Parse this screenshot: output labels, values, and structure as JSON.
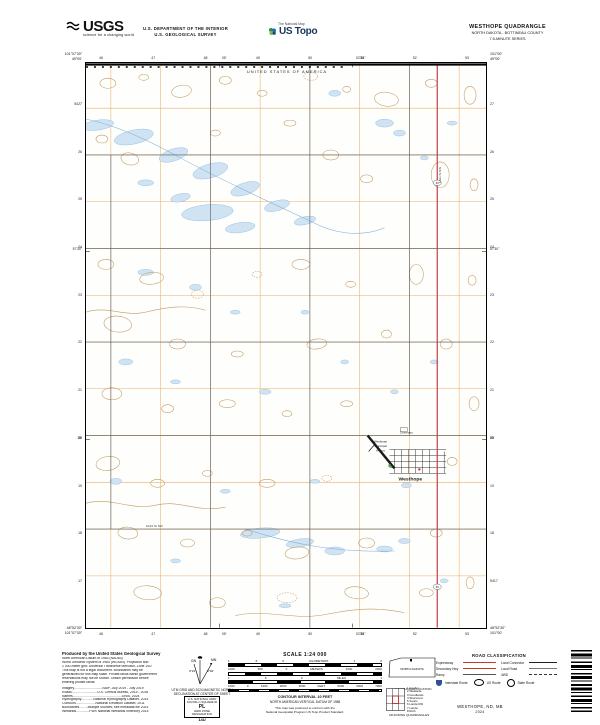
{
  "header": {
    "usgs_logo": "USGS",
    "usgs_tagline": "science for a changing world",
    "dept1": "U.S. DEPARTMENT OF THE INTERIOR",
    "dept2": "U.S. GEOLOGICAL SURVEY",
    "ustopo_small": "The National Map",
    "ustopo_brand": "US Topo",
    "quad_title": "WESTHOPE QUADRANGLE",
    "quad_county": "NORTH DAKOTA - BOTTINEAU COUNTY",
    "quad_series": "7.5-MINUTE SERIES"
  },
  "map": {
    "boundary_label": "UNITED STATES OF AMERICA",
    "grid_top": [
      "46",
      "47",
      "48",
      "49",
      "50",
      "51",
      "52",
      "53"
    ],
    "grid_bottom": [
      "46",
      "47",
      "48",
      "49",
      "50",
      "51",
      "52",
      "53"
    ],
    "grid_left": [
      "5427",
      "26",
      "25",
      "24",
      "23",
      "22",
      "21",
      "20",
      "19",
      "18",
      "17"
    ],
    "grid_right": [
      "27",
      "26",
      "25",
      "24",
      "23",
      "22",
      "21",
      "20",
      "19",
      "18",
      "5417"
    ],
    "corners": {
      "tl_lon": "101°07'30\"",
      "tl_lat": "49°00'",
      "tr_lon": "101°00'",
      "tr_lat": "49°00'",
      "bl_lat": "48°52'30\"",
      "bl_lon": "101°07'30\"",
      "br_lat": "48°52'30\"",
      "br_lon": "101°00'"
    },
    "minutes": {
      "top_1": "05'",
      "top_2": "02'30\"",
      "bottom_1": "05'",
      "bottom_2": "02'30\"",
      "left_1": "57'30\"",
      "left_2": "55'",
      "right_1": "57'30\"",
      "right_2": "55'"
    },
    "labels": {
      "town": "Westhope",
      "airport_1": "Westhope",
      "airport_2": "Municipal",
      "airport_3": "Airport",
      "cemetery": "Cemetery",
      "main_street": "Main St NW",
      "section_street": "103rd St NW",
      "route_number": "83"
    }
  },
  "footer": {
    "produced_by": "Produced by the United States Geological Survey",
    "notes": [
      "North American Datum of 1983 (NAD83)",
      "World Geodetic System of 1984 (WGS84). Projection and",
      "1 000-meter grid: Universal Transverse Mercator, Zone 14U",
      "This map is not a legal document. Boundaries may be",
      "generalized for this map scale. Private lands within government",
      "reservations may not be shown. Obtain permission before",
      "entering private lands."
    ],
    "sources": [
      "Imagery..............................NAIP, July 2019 - July 2019",
      "Roads...........................U.S. Census Bureau, 2015 - 2016",
      "Names....................................................GNIS, 2024",
      "Hydrography.............National Hydrography Dataset, 2014",
      "Contours.....................National Elevation Dataset, 2011",
      "Boundaries.........Multiple sources; see metadata file 2023",
      "Wetlands..............FWS National Wetlands Inventory 2014"
    ],
    "declination": {
      "gn": "GN",
      "mn": "MN",
      "gn_angle": "0°21'",
      "mn_angle": "3°04'",
      "caption1": "UTM GRID AND 2024 MAGNETIC NORTH",
      "caption2": "DECLINATION AT CENTER OF SHEET"
    },
    "usng": {
      "title": "U.S. NATIONAL GRID",
      "sub": "100,000-m SQUARE ID",
      "square_id": "PL",
      "zone_label": "GRID ZONE DESIGNATION",
      "zone": "14U"
    },
    "scale": {
      "title": "SCALE 1:24 000",
      "km_ticks": [
        "1",
        ".5",
        "0",
        "KILOMETERS",
        "1",
        "2"
      ],
      "m_ticks": [
        "1000",
        "500",
        "0",
        "METERS",
        "1000",
        "2000"
      ],
      "mi_ticks": [
        "1",
        ".5",
        "0",
        "MILES",
        "1"
      ],
      "ft_ticks": [
        "1000",
        "0",
        "1000",
        "2000",
        "3000",
        "FEET",
        "5000",
        "6000",
        "7000"
      ],
      "contour": "CONTOUR INTERVAL 10 FEET",
      "datum": "NORTH AMERICAN VERTICAL DATUM OF 1988",
      "conform1": "This map was produced to conform with the",
      "conform2": "National Geospatial Program US Topo Product Standard."
    },
    "state_map": {
      "label": "NORTH DAKOTA",
      "caption": "QUADRANGLE LOCATION"
    },
    "adjoining": {
      "caption": "ADJOINING QUADRANGLES",
      "names": [
        "1 Coulter",
        "2 Waskada",
        "3 Goodlands",
        "4 Sherwood",
        "5 Souris",
        "6 Landa NW",
        "7 Landa",
        "8 Roth"
      ]
    },
    "road_class": {
      "title": "ROAD CLASSIFICATION",
      "row1_left": "Expressway",
      "row1_right": "Local Connector",
      "row2_left": "Secondary Hwy",
      "row2_right": "Local Road",
      "row3_left": "Ramp",
      "row3_right": "4WD",
      "shield_interstate": "Interstate Route",
      "shield_us": "US Route",
      "shield_state": "State Route"
    },
    "sheet_name": "WESTHOPE, ND, MB",
    "sheet_year": "2024"
  }
}
